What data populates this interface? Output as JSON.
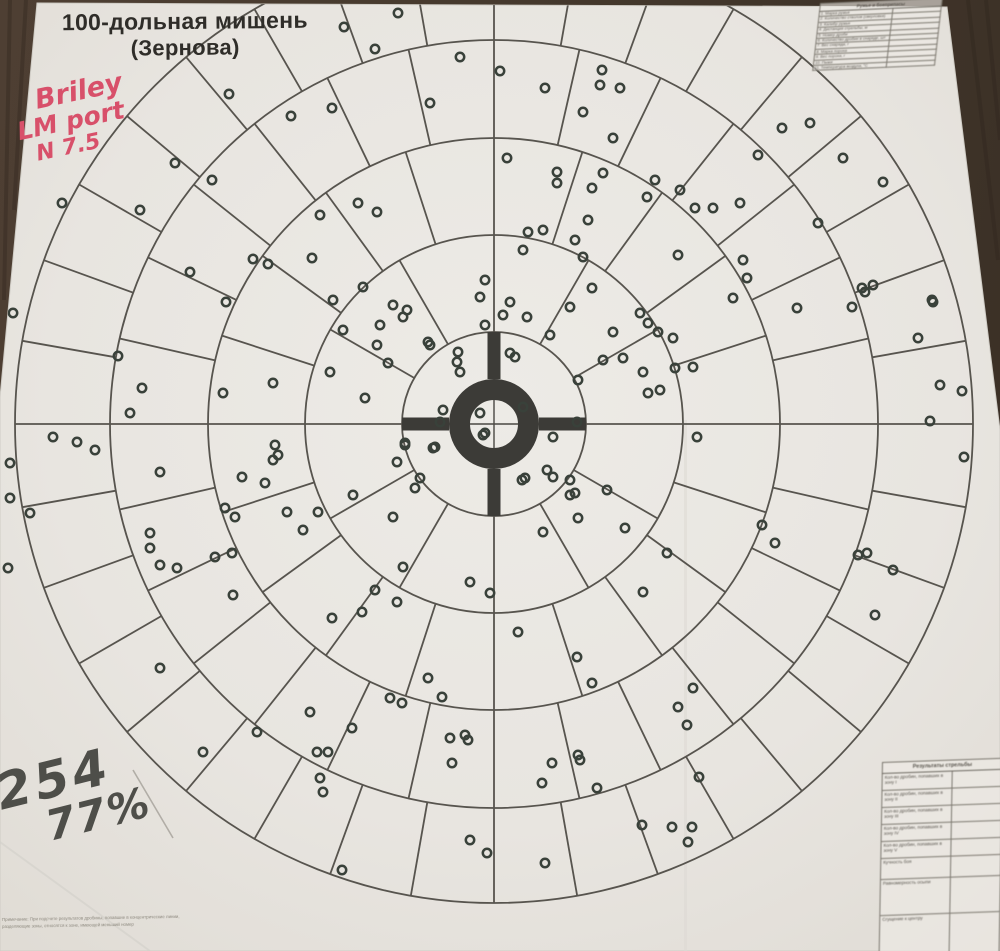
{
  "title": {
    "line1": "100-дольная мишень",
    "line2": "(Зернова)"
  },
  "annotations": {
    "red_note": {
      "lines": [
        "Briley",
        "LM port",
        "N 7.5"
      ],
      "color": "#d8506a"
    },
    "score_note": {
      "count": "254",
      "percent": "77%",
      "color": "#4e4e49"
    }
  },
  "ammo_table": {
    "header": "Ружье и боеприпасы",
    "rows": [
      {
        "label": "1. Марка ружья",
        "value": ""
      },
      {
        "label": "2. Количество стволов (сверловка)",
        "value": ""
      },
      {
        "label": "3. Калибр ружья",
        "value": ""
      },
      {
        "label": "4. Дистанция стрельбы, м",
        "value": ""
      },
      {
        "label": "5. Номер дроби",
        "value": ""
      },
      {
        "label": "6. Количество дробин в снаряде, шт",
        "value": ""
      },
      {
        "label": "7. Вес снаряда, г",
        "value": ""
      },
      {
        "label": "8. Марка пороха",
        "value": ""
      },
      {
        "label": "9. Вес пороха, г",
        "value": ""
      },
      {
        "label": "10. Пыжи",
        "value": ""
      },
      {
        "label": "11. Температура воздуха, °С",
        "value": ""
      }
    ]
  },
  "results_table": {
    "header": "Результаты стрельбы",
    "rows": [
      {
        "label": "Кол-во дробин, попавших в зону I",
        "value": "",
        "h": 17
      },
      {
        "label": "Кол-во дробин, попавших в зону II",
        "value": "",
        "h": 17
      },
      {
        "label": "Кол-во дробин, попавших в зону III",
        "value": "",
        "h": 17
      },
      {
        "label": "Кол-во дробин, попавших в зону IV",
        "value": "",
        "h": 17
      },
      {
        "label": "Кол-во дробин, попавших в зону V",
        "value": "",
        "h": 17
      },
      {
        "label": "Кучность боя",
        "value": "",
        "h": 21
      },
      {
        "label": "Равномерность осыпи",
        "value": "",
        "h": 36
      },
      {
        "label": "Сгущение к центру",
        "value": "",
        "h": 42
      }
    ]
  },
  "footnote": {
    "line1": "Примечание: При подсчете результатов дробины, попавшие в концентрические линии,",
    "line2": "разделяющие зоны, относятся к зоне, имеющей меньший номер"
  },
  "target": {
    "center": {
      "x": 494,
      "y": 424
    },
    "ring_radii": [
      92,
      189,
      286,
      384,
      479
    ],
    "ring_sections": [
      4,
      12,
      20,
      28,
      36
    ],
    "bullseye": {
      "inner_radius": 24,
      "outer_radius": 45,
      "arm_outer_radius": 92,
      "arm_width": 13
    },
    "line_color": "#57544e",
    "line_width": 1.8,
    "bull_color": "#3c3b37"
  },
  "holes": {
    "color": "#39413a",
    "radius": 4.2,
    "stroke_width": 2.5,
    "points": [
      [
        344,
        27
      ],
      [
        375,
        49
      ],
      [
        398,
        13
      ],
      [
        460,
        57
      ],
      [
        500,
        71
      ],
      [
        545,
        88
      ],
      [
        430,
        103
      ],
      [
        332,
        108
      ],
      [
        602,
        70
      ],
      [
        600,
        85
      ],
      [
        620,
        88
      ],
      [
        583,
        112
      ],
      [
        613,
        138
      ],
      [
        782,
        128
      ],
      [
        810,
        123
      ],
      [
        758,
        155
      ],
      [
        843,
        158
      ],
      [
        229,
        94
      ],
      [
        291,
        116
      ],
      [
        507,
        158
      ],
      [
        557,
        172
      ],
      [
        603,
        173
      ],
      [
        557,
        183
      ],
      [
        592,
        188
      ],
      [
        655,
        180
      ],
      [
        647,
        197
      ],
      [
        358,
        203
      ],
      [
        377,
        212
      ],
      [
        320,
        215
      ],
      [
        588,
        220
      ],
      [
        528,
        232
      ],
      [
        543,
        230
      ],
      [
        575,
        240
      ],
      [
        680,
        190
      ],
      [
        695,
        208
      ],
      [
        713,
        208
      ],
      [
        740,
        203
      ],
      [
        883,
        182
      ],
      [
        175,
        163
      ],
      [
        212,
        180
      ],
      [
        140,
        210
      ],
      [
        62,
        203
      ],
      [
        818,
        223
      ],
      [
        312,
        258
      ],
      [
        583,
        257
      ],
      [
        523,
        250
      ],
      [
        363,
        287
      ],
      [
        333,
        300
      ],
      [
        393,
        305
      ],
      [
        407,
        310
      ],
      [
        380,
        325
      ],
      [
        343,
        330
      ],
      [
        403,
        317
      ],
      [
        485,
        280
      ],
      [
        480,
        297
      ],
      [
        510,
        302
      ],
      [
        527,
        317
      ],
      [
        503,
        315
      ],
      [
        485,
        325
      ],
      [
        592,
        288
      ],
      [
        570,
        307
      ],
      [
        640,
        313
      ],
      [
        613,
        332
      ],
      [
        648,
        323
      ],
      [
        658,
        332
      ],
      [
        673,
        338
      ],
      [
        678,
        255
      ],
      [
        743,
        260
      ],
      [
        747,
        278
      ],
      [
        733,
        298
      ],
      [
        933,
        302
      ],
      [
        797,
        308
      ],
      [
        852,
        307
      ],
      [
        190,
        272
      ],
      [
        226,
        302
      ],
      [
        268,
        264
      ],
      [
        13,
        313
      ],
      [
        253,
        259
      ],
      [
        873,
        285
      ],
      [
        862,
        288
      ],
      [
        865,
        292
      ],
      [
        932,
        300
      ],
      [
        377,
        345
      ],
      [
        330,
        372
      ],
      [
        365,
        398
      ],
      [
        388,
        363
      ],
      [
        428,
        342
      ],
      [
        458,
        352
      ],
      [
        457,
        362
      ],
      [
        460,
        372
      ],
      [
        510,
        353
      ],
      [
        515,
        357
      ],
      [
        550,
        335
      ],
      [
        578,
        380
      ],
      [
        603,
        360
      ],
      [
        623,
        358
      ],
      [
        643,
        372
      ],
      [
        660,
        390
      ],
      [
        648,
        393
      ],
      [
        675,
        368
      ],
      [
        693,
        367
      ],
      [
        443,
        410
      ],
      [
        440,
        422
      ],
      [
        480,
        413
      ],
      [
        485,
        433
      ],
      [
        430,
        345
      ],
      [
        918,
        338
      ],
      [
        940,
        385
      ],
      [
        962,
        391
      ],
      [
        930,
        421
      ],
      [
        130,
        413
      ],
      [
        223,
        393
      ],
      [
        273,
        383
      ],
      [
        118,
        356
      ],
      [
        142,
        388
      ],
      [
        523,
        407
      ],
      [
        577,
        422
      ],
      [
        275,
        445
      ],
      [
        278,
        455
      ],
      [
        273,
        460
      ],
      [
        160,
        472
      ],
      [
        242,
        477
      ],
      [
        265,
        483
      ],
      [
        353,
        495
      ],
      [
        397,
        462
      ],
      [
        405,
        445
      ],
      [
        433,
        448
      ],
      [
        420,
        478
      ],
      [
        415,
        488
      ],
      [
        393,
        517
      ],
      [
        225,
        508
      ],
      [
        235,
        517
      ],
      [
        287,
        512
      ],
      [
        318,
        512
      ],
      [
        553,
        437
      ],
      [
        697,
        437
      ],
      [
        522,
        480
      ],
      [
        570,
        480
      ],
      [
        575,
        493
      ],
      [
        607,
        490
      ],
      [
        578,
        518
      ],
      [
        53,
        437
      ],
      [
        77,
        442
      ],
      [
        95,
        450
      ],
      [
        10,
        463
      ],
      [
        10,
        498
      ],
      [
        30,
        513
      ],
      [
        762,
        525
      ],
      [
        435,
        447
      ],
      [
        405,
        443
      ],
      [
        483,
        435
      ],
      [
        553,
        477
      ],
      [
        525,
        478
      ],
      [
        570,
        495
      ],
      [
        964,
        457
      ],
      [
        547,
        470
      ],
      [
        150,
        533
      ],
      [
        150,
        548
      ],
      [
        160,
        565
      ],
      [
        177,
        568
      ],
      [
        215,
        557
      ],
      [
        232,
        553
      ],
      [
        233,
        595
      ],
      [
        332,
        618
      ],
      [
        362,
        612
      ],
      [
        375,
        590
      ],
      [
        397,
        602
      ],
      [
        403,
        567
      ],
      [
        470,
        582
      ],
      [
        490,
        593
      ],
      [
        543,
        532
      ],
      [
        625,
        528
      ],
      [
        667,
        553
      ],
      [
        775,
        543
      ],
      [
        858,
        555
      ],
      [
        867,
        553
      ],
      [
        875,
        615
      ],
      [
        893,
        570
      ],
      [
        643,
        592
      ],
      [
        303,
        530
      ],
      [
        8,
        568
      ],
      [
        160,
        668
      ],
      [
        428,
        678
      ],
      [
        442,
        697
      ],
      [
        390,
        698
      ],
      [
        402,
        703
      ],
      [
        518,
        632
      ],
      [
        577,
        657
      ],
      [
        592,
        683
      ],
      [
        693,
        688
      ],
      [
        257,
        732
      ],
      [
        203,
        752
      ],
      [
        317,
        752
      ],
      [
        328,
        752
      ],
      [
        352,
        728
      ],
      [
        450,
        738
      ],
      [
        465,
        735
      ],
      [
        678,
        707
      ],
      [
        687,
        725
      ],
      [
        320,
        778
      ],
      [
        323,
        792
      ],
      [
        452,
        763
      ],
      [
        468,
        740
      ],
      [
        552,
        763
      ],
      [
        580,
        760
      ],
      [
        542,
        783
      ],
      [
        597,
        788
      ],
      [
        699,
        777
      ],
      [
        578,
        755
      ],
      [
        310,
        712
      ],
      [
        342,
        870
      ],
      [
        470,
        840
      ],
      [
        487,
        853
      ],
      [
        545,
        863
      ],
      [
        642,
        825
      ],
      [
        672,
        827
      ],
      [
        692,
        827
      ],
      [
        688,
        842
      ]
    ]
  },
  "colors": {
    "paper": "#e8e5e0",
    "wood": "#46382d"
  }
}
